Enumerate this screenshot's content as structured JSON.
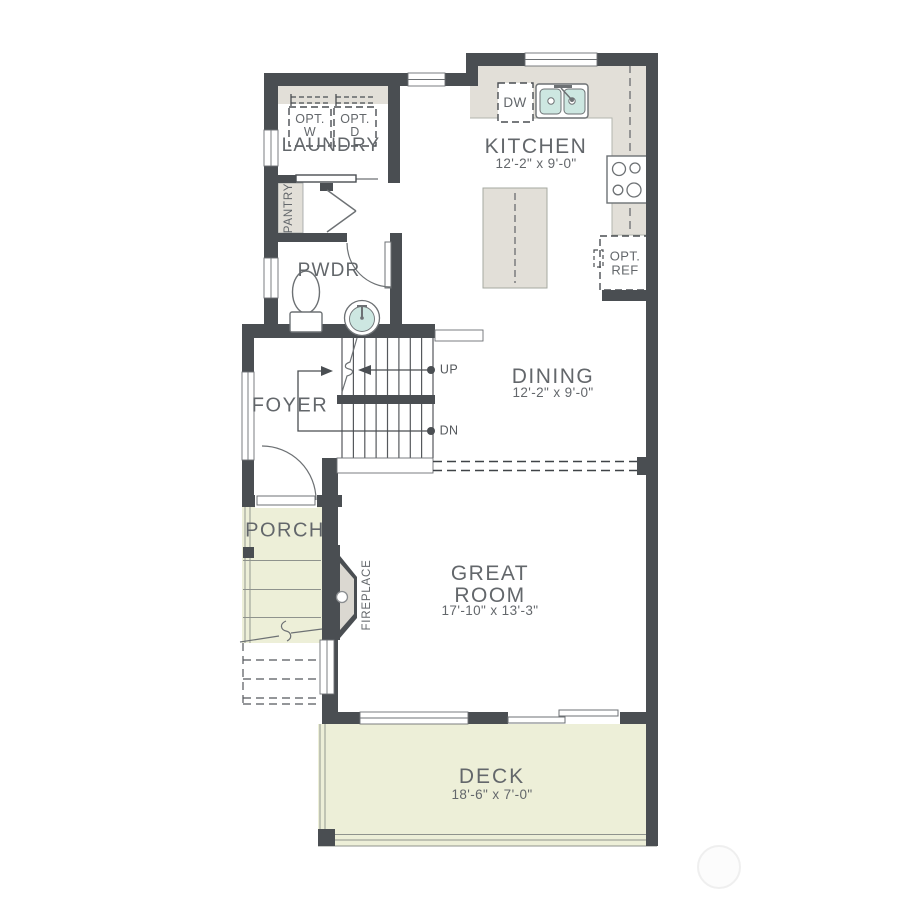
{
  "plan": {
    "rooms": {
      "laundry": {
        "name": "LAUNDRY"
      },
      "pantry": {
        "name": "PANTRY"
      },
      "powder": {
        "name": "PWDR"
      },
      "kitchen": {
        "name": "KITCHEN",
        "dims": "12'-2\" x 9'-0\""
      },
      "dining": {
        "name": "DINING",
        "dims": "12'-2\" x 9'-0\""
      },
      "foyer": {
        "name": "FOYER"
      },
      "great_room": {
        "name": "GREAT\nROOM",
        "dims": "17'-10\" x 13'-3\""
      },
      "porch": {
        "name": "PORCH"
      },
      "deck": {
        "name": "DECK",
        "dims": "18'-6\" x 7'-0\""
      },
      "fireplace": {
        "name": "FIREPLACE"
      }
    },
    "fixtures": {
      "washer_opt": "OPT.\nW",
      "dryer_opt": "OPT.\nD",
      "dishwasher": "DW",
      "fridge_opt": "OPT.\nREF"
    },
    "stairs": {
      "up": "UP",
      "down": "DN"
    },
    "colors": {
      "wall": "#4a4e52",
      "counter": "#e2dfd8",
      "outdoor": "#edefd8",
      "water_fixture": "#cde7e1",
      "text": "#63676b"
    }
  }
}
